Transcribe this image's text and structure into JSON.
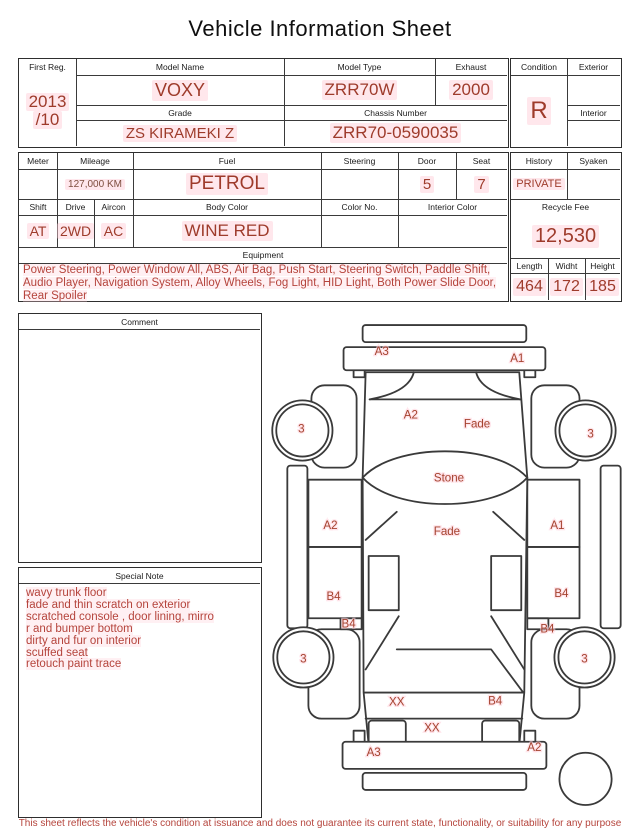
{
  "title": "Vehicle Information Sheet",
  "colors": {
    "value_red": "#9e3b2b",
    "note_red": "#b5443c",
    "mileage_brown": "#7e4e3e",
    "halo_pink": "#ffccd6",
    "line_dark": "#3a3a3a"
  },
  "reg_table": {
    "first_reg_label": "First Reg.",
    "first_reg_line1": "2013",
    "first_reg_line2": "/10",
    "model_name_label": "Model Name",
    "model_name": "VOXY",
    "model_type_label": "Model Type",
    "model_type": "ZRR70W",
    "exhaust_label": "Exhaust",
    "exhaust": "2000",
    "grade_label": "Grade",
    "grade": "ZS KIRAMEKI Z",
    "chassis_label": "Chassis Number",
    "chassis": "ZRR70-0590035"
  },
  "condition_box": {
    "condition_label": "Condition",
    "condition": "R",
    "exterior_label": "Exterior",
    "exterior": "",
    "interior_label": "Interior",
    "interior": ""
  },
  "spec_table": {
    "meter_label": "Meter",
    "meter": "",
    "mileage_label": "Mileage",
    "mileage": "127,000 KM",
    "fuel_label": "Fuel",
    "fuel": "PETROL",
    "steering_label": "Steering",
    "steering": "",
    "door_label": "Door",
    "door": "5",
    "seat_label": "Seat",
    "seat": "7",
    "shift_label": "Shift",
    "shift": "AT",
    "drive_label": "Drive",
    "drive": "2WD",
    "aircon_label": "Aircon",
    "aircon": "AC",
    "body_color_label": "Body Color",
    "body_color": "WINE RED",
    "color_no_label": "Color No.",
    "color_no": "",
    "interior_color_label": "Interior Color",
    "interior_color": ""
  },
  "history_box": {
    "history_label": "History",
    "history": "PRIVATE",
    "syaken_label": "Syaken",
    "syaken": "",
    "recycle_fee_label": "Recycle Fee",
    "recycle_fee": "12,530",
    "length_label": "Length",
    "length": "464",
    "widht_label": "Widht",
    "widht": "172",
    "height_label": "Height",
    "height": "185"
  },
  "equipment": {
    "label": "Equipment",
    "text": "Power Steering, Power Window  All, ABS, Air Bag, Push Start, Steering Switch, Paddle Shift, Audio Player, Navigation System, Alloy Wheels, Fog Light, HID Light, Both Power Slide Door, Rear Spoiler"
  },
  "comment": {
    "label": "Comment",
    "text": ""
  },
  "special_note": {
    "label": "Special Note",
    "lines": [
      "wavy trunk floor",
      "fade and thin scratch on exterior",
      "scratched console , door lining, mirro",
      "r and bumper bottom",
      "dirty and fur on interior",
      "scuffed seat",
      "retouch paint trace"
    ]
  },
  "diagram": {
    "labels": [
      {
        "t": "A3",
        "x": 113,
        "y": 37
      },
      {
        "t": "A1",
        "x": 248,
        "y": 44
      },
      {
        "t": "A2",
        "x": 142,
        "y": 100
      },
      {
        "t": "Fade",
        "x": 208,
        "y": 109
      },
      {
        "t": "Stone",
        "x": 180,
        "y": 163
      },
      {
        "t": "A2",
        "x": 62,
        "y": 210
      },
      {
        "t": "Fade",
        "x": 178,
        "y": 216
      },
      {
        "t": "A1",
        "x": 288,
        "y": 210
      },
      {
        "t": "B4",
        "x": 65,
        "y": 281
      },
      {
        "t": "B4",
        "x": 292,
        "y": 278
      },
      {
        "t": "B4",
        "x": 80,
        "y": 308
      },
      {
        "t": "B4",
        "x": 278,
        "y": 313
      },
      {
        "t": "3",
        "x": 33,
        "y": 114
      },
      {
        "t": "3",
        "x": 321,
        "y": 119
      },
      {
        "t": "3",
        "x": 35,
        "y": 343
      },
      {
        "t": "3",
        "x": 315,
        "y": 343
      },
      {
        "t": "XX",
        "x": 128,
        "y": 386
      },
      {
        "t": "B4",
        "x": 226,
        "y": 385
      },
      {
        "t": "XX",
        "x": 163,
        "y": 412
      },
      {
        "t": "A3",
        "x": 105,
        "y": 436
      },
      {
        "t": "A2",
        "x": 265,
        "y": 431
      }
    ]
  },
  "footer": {
    "disclaimer": "This sheet reflects the vehicle's condition at issuance and does not guarantee its current state, functionality, or suitability for any purpose"
  }
}
